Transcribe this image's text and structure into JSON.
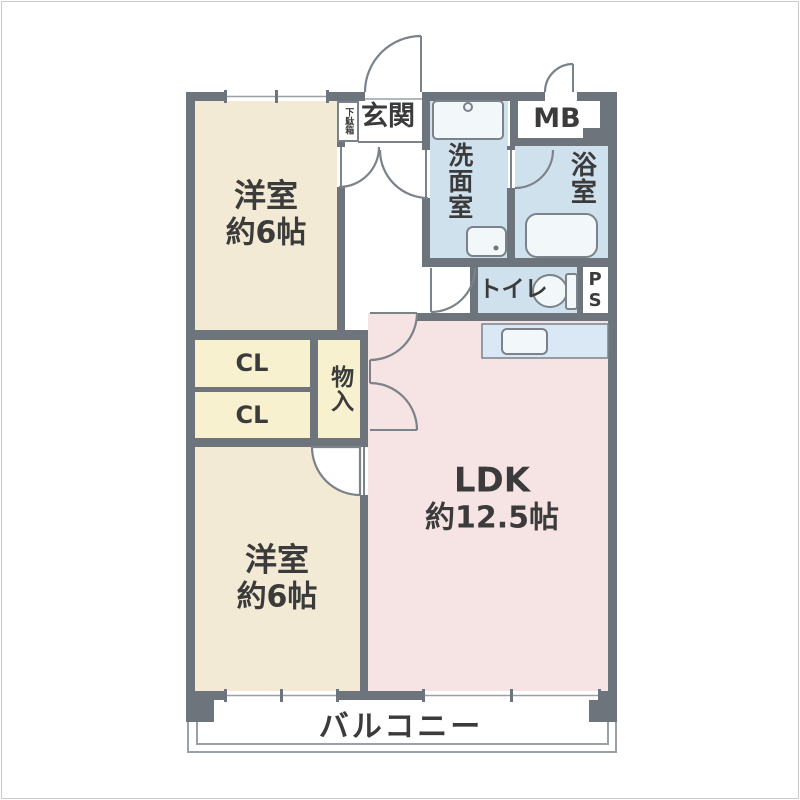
{
  "palette": {
    "wall": "#6d747c",
    "cream": "#f3ead5",
    "yellow": "#f8f1d0",
    "pink": "#f5e4e3",
    "blue": "#cfe1ed",
    "counter": "#d9e8f4",
    "fixture": "#f2f7fa",
    "line": "#7b828a",
    "glass": "#9aa0a6",
    "balconyLine": "#98a1a8",
    "text": "#3b3b3b"
  },
  "rooms": {
    "bedroom1": {
      "name": "洋室",
      "size": "約6帖"
    },
    "bedroom2": {
      "name": "洋室",
      "size": "約6帖"
    },
    "ldk": {
      "name": "LDK",
      "size": "約12.5帖"
    },
    "entrance": "玄関",
    "shoe_cabinet": "下駄箱",
    "washroom": "洗面室",
    "bathroom": "浴室",
    "toilet": "トイレ",
    "meter_box": "MB",
    "pipe_space": "PS",
    "closet_top": "CL",
    "closet_bottom": "CL",
    "storage": "物入",
    "balcony": "バルコニー"
  }
}
